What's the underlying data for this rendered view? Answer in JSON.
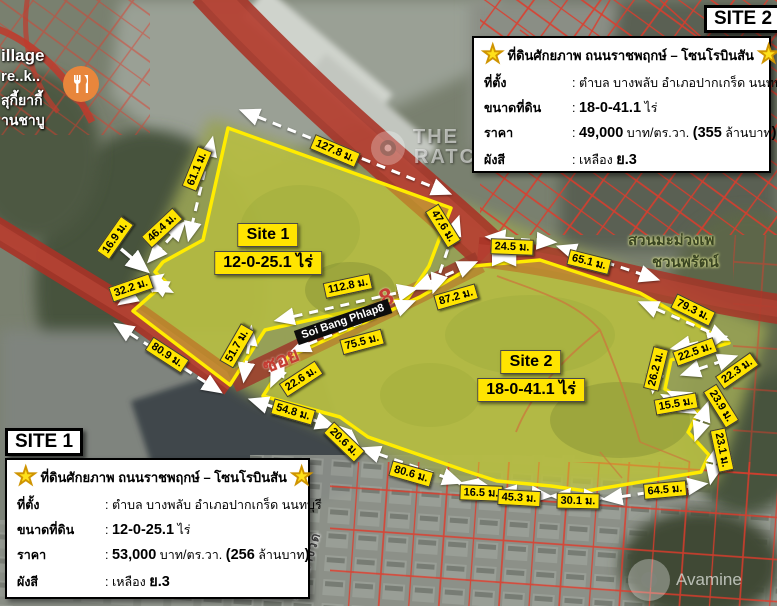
{
  "headers": {
    "site1": "SITE 1",
    "site2": "SITE 2"
  },
  "site_labels": {
    "site1": {
      "name": "Site 1",
      "area": "12-0-25.1 ไร่"
    },
    "site2": {
      "name": "Site 2",
      "area": "18-0-41.1 ไร่"
    }
  },
  "info_boxes": {
    "site1": {
      "title": "ที่ดินศักยภาพ ถนนราชพฤกษ์ – โซนโรบินสัน",
      "rows": [
        {
          "label": "ที่ตั้ง",
          "parts": [
            {
              "t": ": ตำบล บางพลับ อำเภอปากเกร็ด นนทบุรี",
              "b": 0
            }
          ]
        },
        {
          "label": "ขนาดที่ดิน",
          "parts": [
            {
              "t": ": ",
              "b": 0
            },
            {
              "t": "12-0-25.1",
              "b": 1
            },
            {
              "t": " ไร่",
              "b": 0
            }
          ]
        },
        {
          "label": "ราคา",
          "parts": [
            {
              "t": ": ",
              "b": 0
            },
            {
              "t": "53,000",
              "b": 1
            },
            {
              "t": " บาท/ตร.วา. ",
              "b": 0
            },
            {
              "t": "(256",
              "b": 1
            },
            {
              "t": " ล้านบาท",
              "b": 0
            },
            {
              "t": ")",
              "b": 1
            }
          ]
        },
        {
          "label": "ผังสี",
          "parts": [
            {
              "t": ": เหลือง ",
              "b": 0
            },
            {
              "t": "ย.3",
              "b": 1
            }
          ]
        }
      ]
    },
    "site2": {
      "title": "ที่ดินศักยภาพ ถนนราชพฤกษ์ – โซนโรบินสัน",
      "rows": [
        {
          "label": "ที่ตั้ง",
          "parts": [
            {
              "t": ": ตำบล บางพลับ อำเภอปากเกร็ด นนทบุรี",
              "b": 0
            }
          ]
        },
        {
          "label": "ขนาดที่ดิน",
          "parts": [
            {
              "t": ": ",
              "b": 0
            },
            {
              "t": "18-0-41.1",
              "b": 1
            },
            {
              "t": " ไร่",
              "b": 0
            }
          ]
        },
        {
          "label": "ราคา",
          "parts": [
            {
              "t": ": ",
              "b": 0
            },
            {
              "t": "49,000",
              "b": 1
            },
            {
              "t": " บาท/ตร.วา. ",
              "b": 0
            },
            {
              "t": "(355",
              "b": 1
            },
            {
              "t": " ล้านบาท",
              "b": 0
            },
            {
              "t": ")",
              "b": 1
            }
          ]
        },
        {
          "label": "ผังสี",
          "parts": [
            {
              "t": ": เหลือง ",
              "b": 0
            },
            {
              "t": "ย.3",
              "b": 1
            }
          ]
        }
      ]
    }
  },
  "measurements": [
    {
      "id": "m127_8",
      "text": "127.8 ม."
    },
    {
      "id": "m61_1",
      "text": "61.1 ม."
    },
    {
      "id": "m46_4",
      "text": "46.4 ม."
    },
    {
      "id": "m16_9",
      "text": "16.9 ม."
    },
    {
      "id": "m32_2",
      "text": "32.2 ม."
    },
    {
      "id": "m80_9",
      "text": "80.9 ม."
    },
    {
      "id": "m51_7",
      "text": "51.7 ม."
    },
    {
      "id": "m112_8",
      "text": "112.8 ม."
    },
    {
      "id": "m47_6",
      "text": "47.6 ม."
    },
    {
      "id": "m24_5",
      "text": "24.5 ม."
    },
    {
      "id": "m65_1",
      "text": "65.1 ม."
    },
    {
      "id": "m87_2",
      "text": "87.2 ม."
    },
    {
      "id": "m75_5",
      "text": "75.5 ม."
    },
    {
      "id": "m22_6",
      "text": "22.6 ม."
    },
    {
      "id": "m54_8",
      "text": "54.8 ม."
    },
    {
      "id": "m20_6",
      "text": "20.6 ม."
    },
    {
      "id": "m80_6",
      "text": "80.6 ม."
    },
    {
      "id": "m16_5",
      "text": "16.5 ม."
    },
    {
      "id": "m45_3",
      "text": "45.3 ม."
    },
    {
      "id": "m30_1",
      "text": "30.1 ม."
    },
    {
      "id": "m64_5",
      "text": "64.5 ม."
    },
    {
      "id": "m79_3",
      "text": "79.3 ม."
    },
    {
      "id": "m22_5",
      "text": "22.5 ม."
    },
    {
      "id": "m22_3",
      "text": "22.3 ม."
    },
    {
      "id": "m26_2",
      "text": "26.2 ม."
    },
    {
      "id": "m15_5",
      "text": "15.5 ม."
    },
    {
      "id": "m23_9",
      "text": "23.9 ม."
    },
    {
      "id": "m23_1",
      "text": "23.1 ม."
    }
  ],
  "road_labels": {
    "soi_sign": "Soi Bang Phlap8",
    "soi_painted": "ซอย",
    "soi_number": "8",
    "bottom_road": "ซอยบางวัด"
  },
  "map_labels": {
    "village_1": "illage",
    "village_2": "re..k..",
    "village_3": "สุกี้ยากี้",
    "village_4": "านชาบู",
    "garden_1": "สวนมะม่วงเพ",
    "garden_2": "ชวนพรัตน์"
  },
  "watermarks": {
    "the_1": "THE",
    "the_2": "RATC",
    "avamine": "Avamine"
  },
  "colors": {
    "label_yellow": "#ffe400",
    "polygon_stroke": "#ffec00",
    "road_red": "#a83226",
    "cadastral_red": "#df3b2b"
  }
}
